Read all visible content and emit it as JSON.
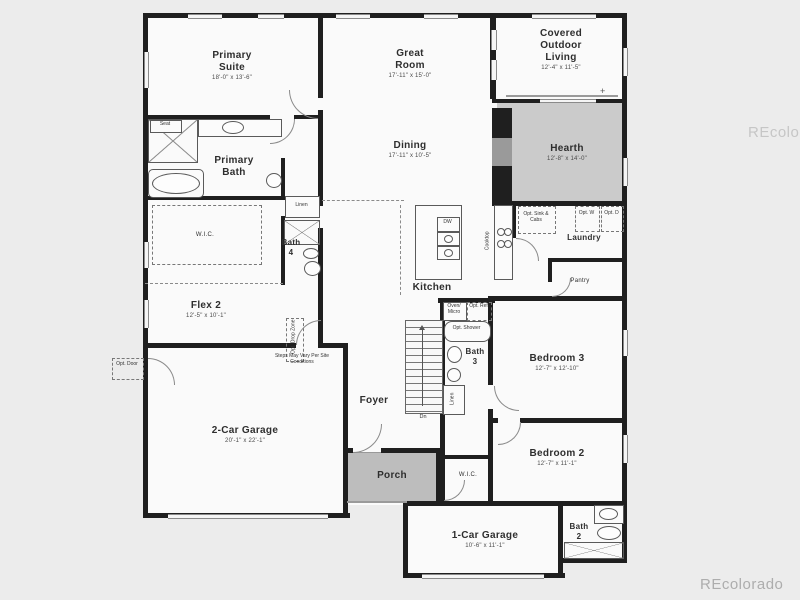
{
  "rooms": {
    "primary_suite": {
      "name": "Primary Suite",
      "dims": "18'-0\" x 13'-6\""
    },
    "great_room": {
      "name": "Great Room",
      "dims": "17'-11\" x 15'-0\""
    },
    "covered_outdoor": {
      "name": "Covered Outdoor Living",
      "dims": "12'-4\" x 11'-5\""
    },
    "hearth": {
      "name": "Hearth",
      "dims": "12'-8\" x 14'-0\""
    },
    "dining": {
      "name": "Dining",
      "dims": "17'-11\" x 10'-5\""
    },
    "primary_bath": {
      "name": "Primary Bath"
    },
    "wic_primary": {
      "name": "W.I.C."
    },
    "bath_4": {
      "name": "Bath 4"
    },
    "linen": {
      "name": "Linen"
    },
    "kitchen": {
      "name": "Kitchen"
    },
    "laundry": {
      "name": "Laundry"
    },
    "pantry": {
      "name": "Pantry"
    },
    "flex_2": {
      "name": "Flex 2",
      "dims": "12'-5\" x 10'-1\""
    },
    "bath_3": {
      "name": "Bath 3"
    },
    "bedroom_3": {
      "name": "Bedroom 3",
      "dims": "12'-7\" x 12'-10\""
    },
    "foyer": {
      "name": "Foyer"
    },
    "garage_2": {
      "name": "2-Car Garage",
      "dims": "20'-1\" x 22'-1\""
    },
    "porch": {
      "name": "Porch"
    },
    "bedroom_2": {
      "name": "Bedroom 2",
      "dims": "12'-7\" x 11'-1\""
    },
    "wic_2": {
      "name": "W.I.C."
    },
    "garage_1": {
      "name": "1-Car Garage",
      "dims": "10'-6\" x 11'-1\""
    },
    "bath_2": {
      "name": "Bath 2"
    }
  },
  "annotations": {
    "seat": "Seat",
    "linen_hall": "Linen",
    "dw": "DW",
    "cooktop": "Cooktop",
    "opt_sink_cabs": "Opt. Sink & Cabs",
    "opt_w": "Opt. W",
    "opt_d": "Opt. D",
    "oven_micro": "Oven/ Micro",
    "opt_ref": "Opt. Ref",
    "opt_shower": "Opt. Shower",
    "opt_door": "Opt. Door",
    "opt_drop_zone": "Opt. Drop Zone",
    "steps_note": "Steps May Vary Per Site Conditions",
    "dn": "Dn",
    "plus_marker": "+"
  },
  "watermarks": {
    "side": "REcolorado",
    "corner": "REcolorado"
  },
  "colors": {
    "wall": "#1f1f1f",
    "shaded_room": "#cbcbcb",
    "porch": "#bdbdbd",
    "background": "#ececec",
    "watermark": "#b3b3b3"
  }
}
